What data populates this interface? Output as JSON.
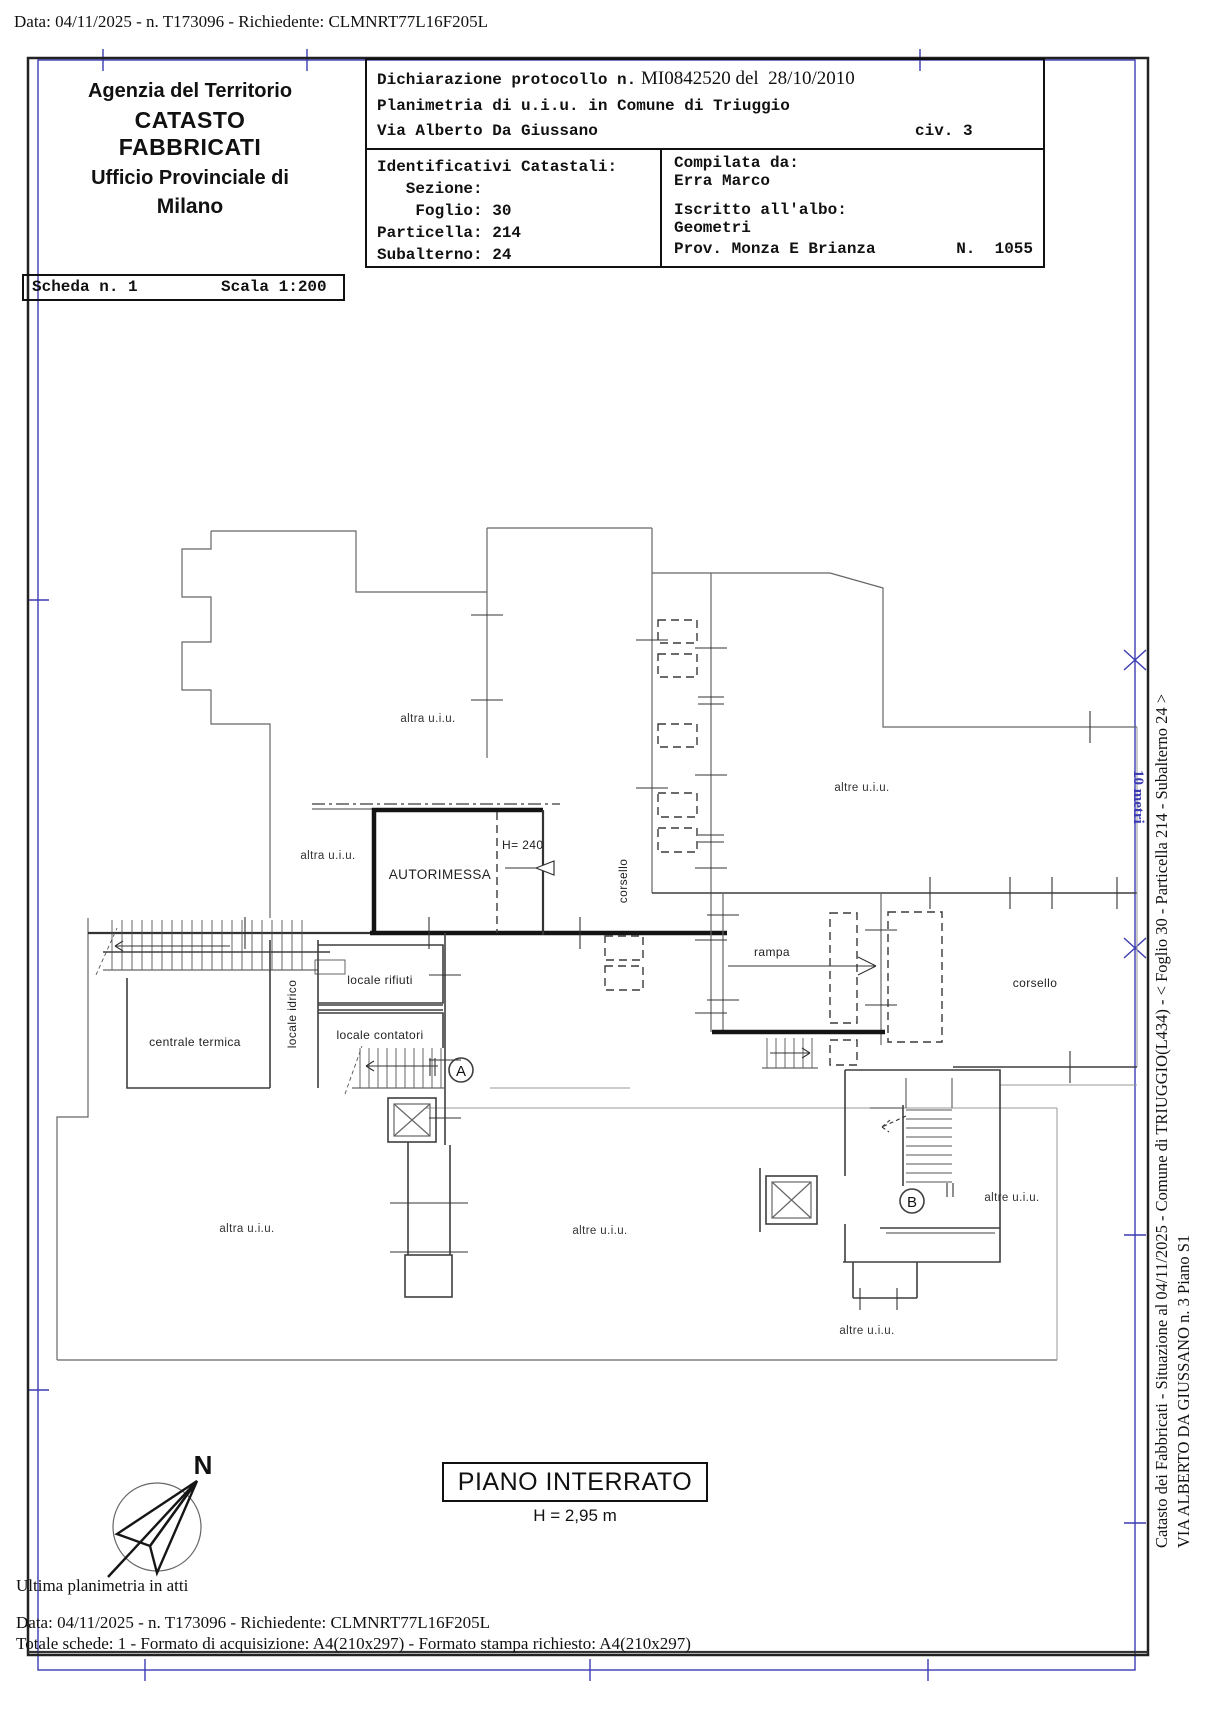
{
  "header": {
    "data_line": "Data: 04/11/2025 - n. T173096 - Richiedente: CLMNRT77L16F205L",
    "agency": {
      "line1": "Agenzia del Territorio",
      "line2": "CATASTO FABBRICATI",
      "line3": "Ufficio Provinciale di",
      "line4": "Milano"
    },
    "declaration": {
      "protocol_label": "Dichiarazione protocollo n.",
      "protocol_value": " MI0842520 del  28/10/2010",
      "planimetria": "Planimetria di u.i.u. in Comune di Triuggio",
      "street": "Via Alberto Da Giussano",
      "civic": "civ. 3"
    },
    "identifiers": {
      "title": "Identificativi Catastali:",
      "sezione": "   Sezione:",
      "foglio": "    Foglio: 30",
      "particella": "Particella: 214",
      "subalterno": "Subalterno: 24"
    },
    "compiler": {
      "label": "Compilata da:",
      "name": "Erra Marco",
      "albo_label": "Iscritto all'albo:",
      "albo_value": "Geometri",
      "prov": "Prov. Monza E Brianza",
      "number": "N.  1055"
    },
    "sheet": {
      "scheda": "Scheda n. 1",
      "scala": "Scala 1:200"
    }
  },
  "plan": {
    "labels": {
      "altra": "altra u.i.u.",
      "altre": "altre u.i.u.",
      "autorimessa": "AUTORIMESSA",
      "h240": "H= 240",
      "corsello": "corsello",
      "rampa": "rampa",
      "locale_rifiuti": "locale rifiuti",
      "locale_idrico": "locale idrico",
      "locale_contatori": "locale contatori",
      "centrale_termica": "centrale termica",
      "stair_a": "A",
      "stair_b": "B",
      "compass_n": "N"
    },
    "title": "PIANO INTERRATO",
    "height_note": "H = 2,95 m",
    "scalebar_label": "10 metri"
  },
  "footer": {
    "ultima": "Ultima planimetria in atti",
    "data_line": "Data: 04/11/2025 - n. T173096 - Richiedente: CLMNRT77L16F205L",
    "totale": "Totale schede: 1 - Formato di acquisizione: A4(210x297)  - Formato stampa richiesto: A4(210x297)"
  },
  "sidebar": {
    "line1": "Catasto dei Fabbricati - Situazione al 04/11/2025 - Comune di TRIUGGIO(L434) - <  Foglio 30 - Particella  214 - Subalterno 24 >",
    "line2": "VIA ALBERTO DA GIUSSANO n. 3 Piano S1"
  },
  "colors": {
    "frame_blue": "#3b3bb4",
    "ink": "#111111",
    "wall": "#3f3f3f"
  }
}
